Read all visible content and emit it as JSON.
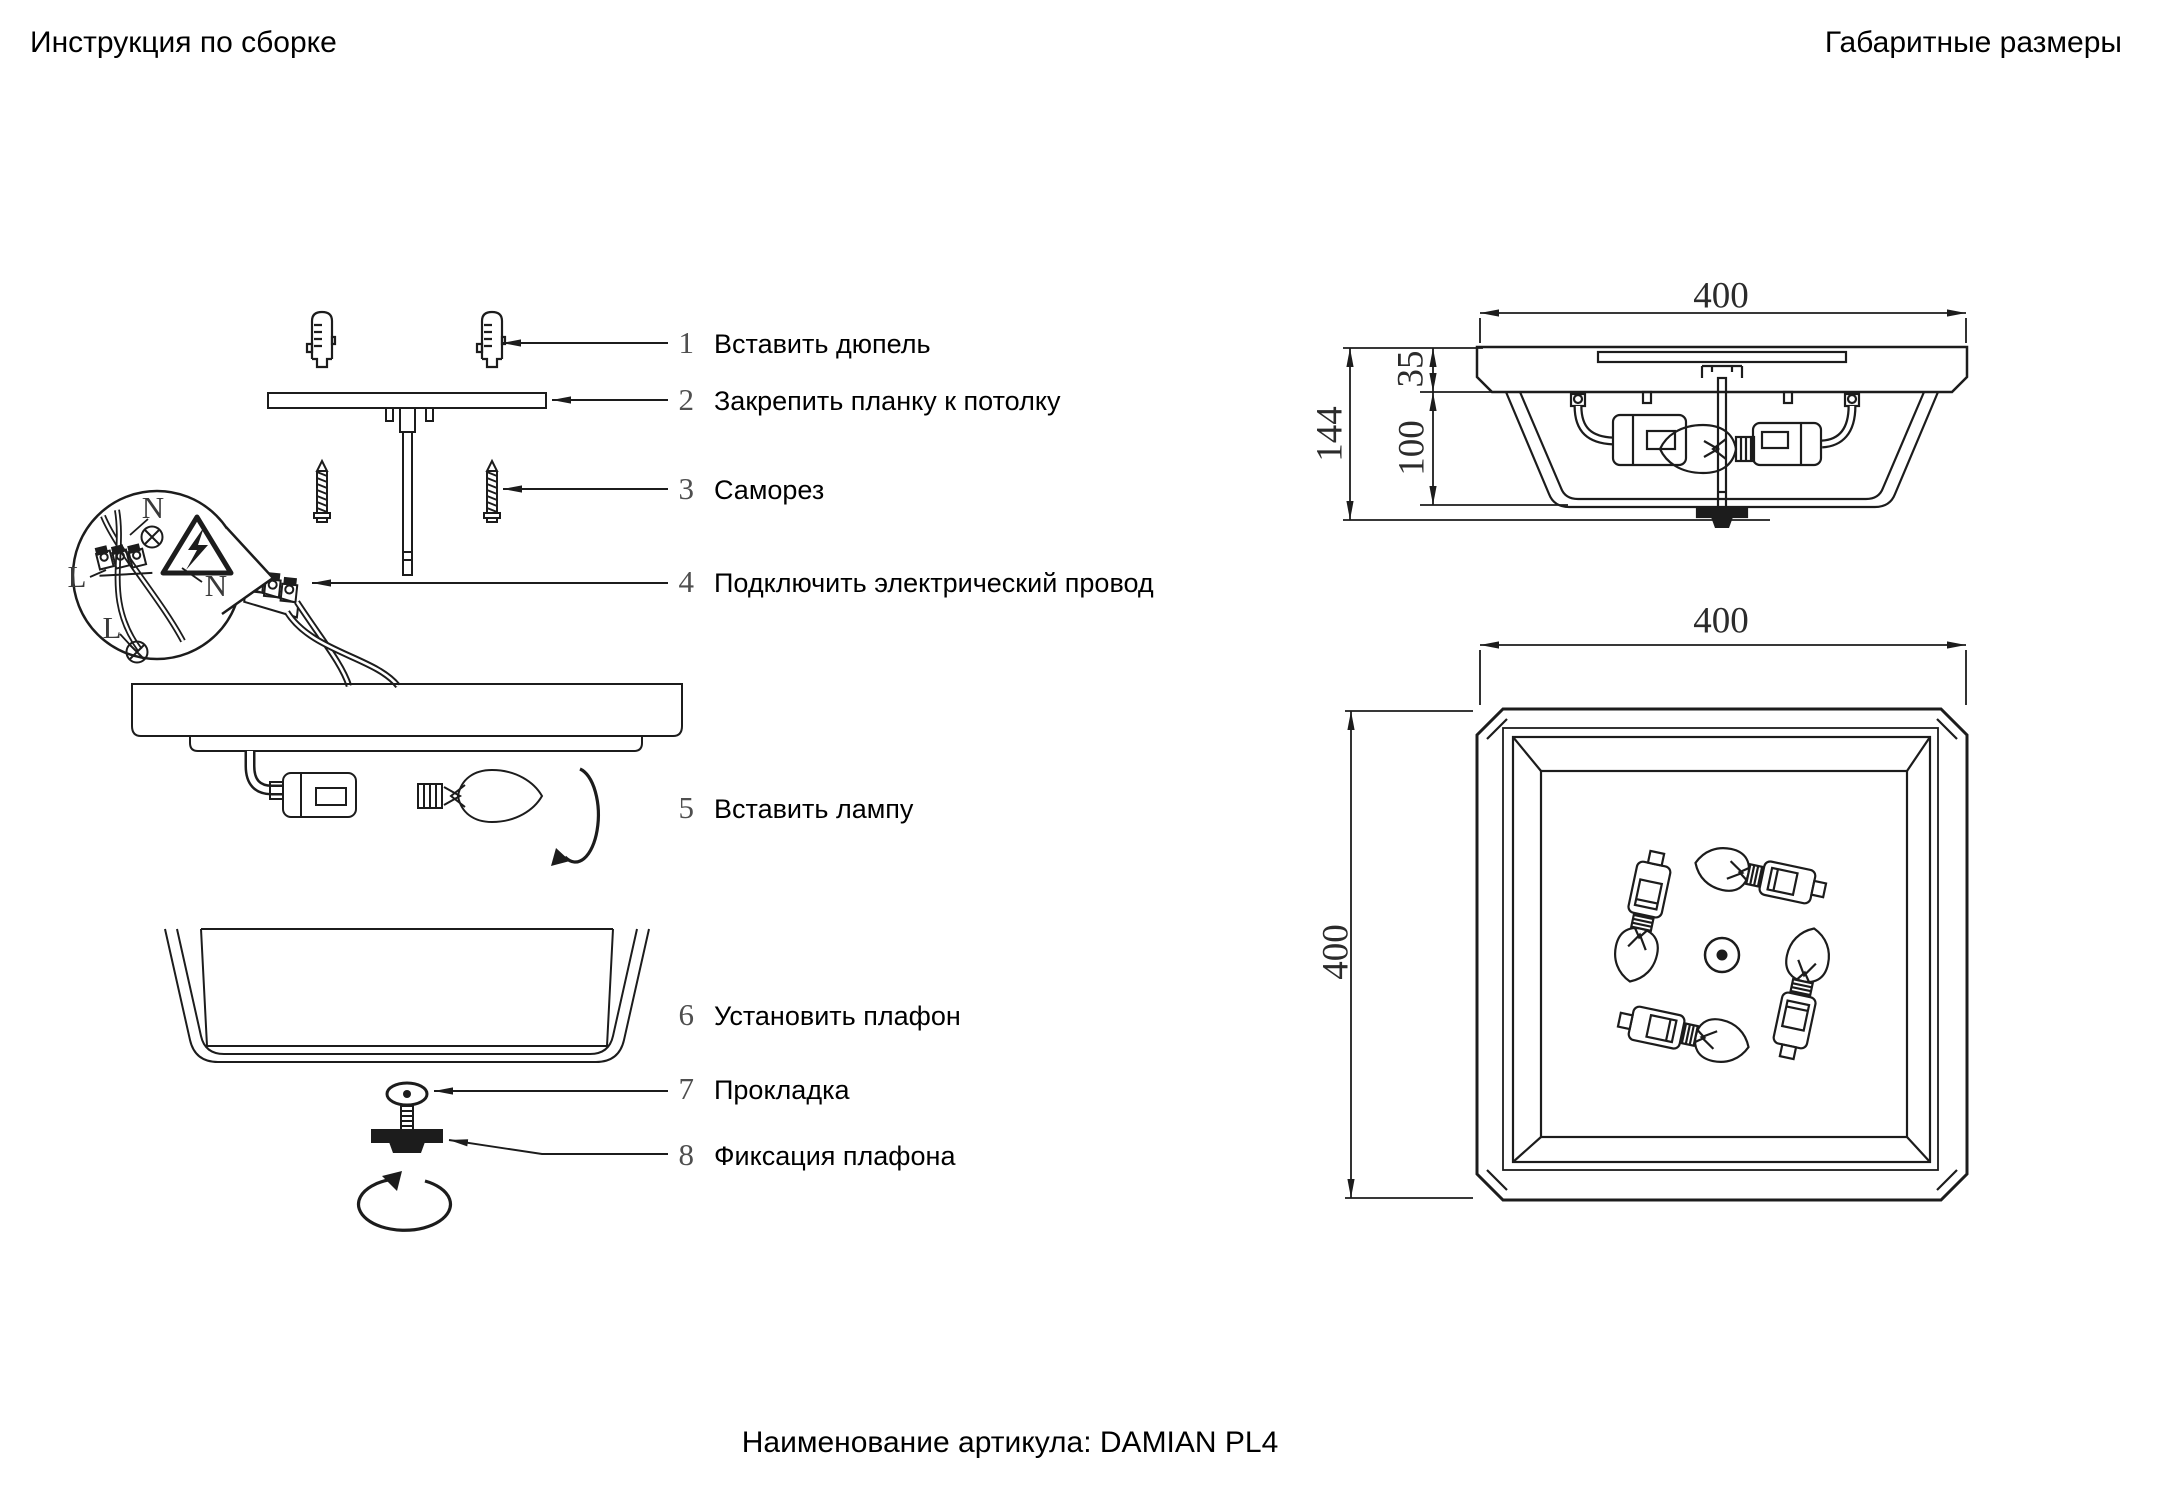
{
  "header": {
    "title_left": "Инструкция по сборке",
    "title_right": "Габаритные размеры"
  },
  "footer": {
    "article_label": "Наименование артикула: DAMIAN PL4"
  },
  "assembly_steps": [
    {
      "num": "1",
      "label": "Вставить дюпель"
    },
    {
      "num": "2",
      "label": "Закрепить планку к потолку"
    },
    {
      "num": "3",
      "label": "Саморез"
    },
    {
      "num": "4",
      "label": "Подключить электрический провод"
    },
    {
      "num": "5",
      "label": "Вставить лампу"
    },
    {
      "num": "6",
      "label": "Установить плафон"
    },
    {
      "num": "7",
      "label": "Прокладка"
    },
    {
      "num": "8",
      "label": "Фиксация плафона"
    }
  ],
  "wiring_callout": {
    "n_top": "N",
    "l_left": "L",
    "n_right": "N",
    "l_bottom": "L"
  },
  "dimensions": {
    "side_view": {
      "width": "400",
      "plate_height": "35",
      "shade_height": "100",
      "total_height": "144"
    },
    "top_view": {
      "width": "400",
      "height": "400"
    }
  },
  "drawing": {
    "line_color": "#1c1c1c",
    "number_color": "#4f4f4f",
    "background": "#ffffff"
  }
}
